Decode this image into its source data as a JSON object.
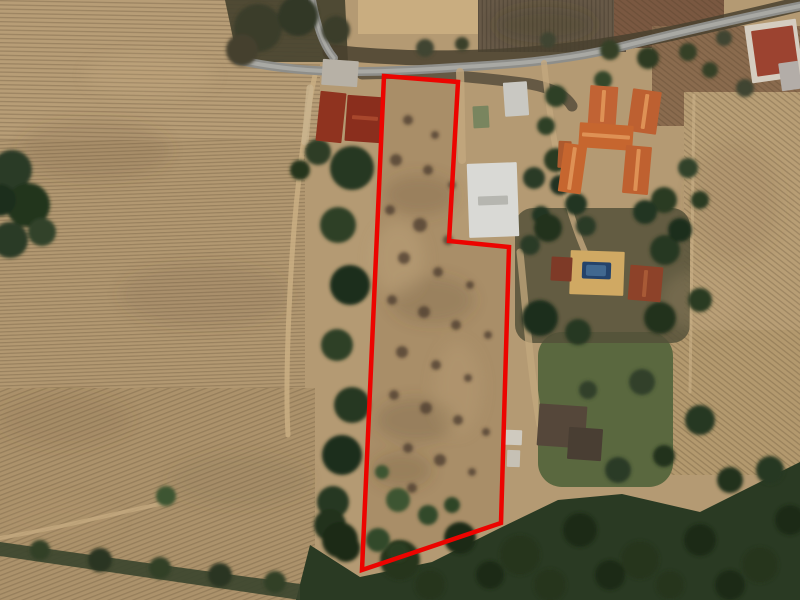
{
  "view": {
    "type": "satellite-aerial-imagery",
    "overlay": "land-parcel-boundary",
    "boundary_color": "#ec0400"
  },
  "scene": {
    "canvas": {
      "width": 800,
      "height": 600
    },
    "base_color": "#b49a73",
    "parcel": {
      "points": "384,76 458,82 449,241 509,247 501,523 362,570",
      "fill": "#a98e68",
      "stroke": "#ec0400",
      "stroke_width": 4.5
    },
    "parcel_tree_color": "#4a3b2c",
    "fields": [
      {
        "name": "field-west-top",
        "x": 0,
        "y": 0,
        "w": 320,
        "h": 150,
        "fill": "#b79d76",
        "pattern": "pat-rows-h"
      },
      {
        "name": "field-west-mid",
        "x": 0,
        "y": 140,
        "w": 305,
        "h": 255,
        "fill": "#b29871",
        "pattern": "pat-rows-h2"
      },
      {
        "name": "field-west-bottom",
        "x": 0,
        "y": 388,
        "w": 315,
        "h": 217,
        "fill": "#ac926b",
        "pattern": "pat-rows-d1"
      },
      {
        "name": "field-north-bare",
        "x": 358,
        "y": 0,
        "w": 125,
        "h": 34,
        "fill": "#c9ad80"
      },
      {
        "name": "field-north-dark",
        "x": 478,
        "y": 0,
        "w": 148,
        "h": 52,
        "fill": "#675947",
        "pattern": "pat-rows-v"
      },
      {
        "name": "field-north-red",
        "x": 614,
        "y": 0,
        "w": 110,
        "h": 48,
        "fill": "#7a5841",
        "pattern": "pat-rows-d2"
      },
      {
        "name": "field-ne-brown",
        "x": 652,
        "y": 26,
        "w": 148,
        "h": 100,
        "fill": "#8a6b4e",
        "pattern": "pat-rows-d2"
      },
      {
        "name": "field-east",
        "x": 684,
        "y": 92,
        "w": 116,
        "h": 305,
        "fill": "#b89e75",
        "pattern": "pat-rows-d2"
      },
      {
        "name": "field-se",
        "x": 655,
        "y": 330,
        "w": 145,
        "h": 145,
        "fill": "#b3996e",
        "pattern": "pat-rows-d2"
      },
      {
        "name": "lawn-se",
        "x": 538,
        "y": 332,
        "w": 135,
        "h": 155,
        "fill": "#5a683f",
        "rx": 24
      },
      {
        "name": "compound-ground",
        "x": 515,
        "y": 208,
        "w": 175,
        "h": 135,
        "fill": "#55513a",
        "rx": 18,
        "opacity": 0.85
      }
    ],
    "polys": [
      {
        "name": "treeband-northwest",
        "points": "225,0 345,0 348,62 238,62",
        "fill": "#46432f",
        "opacity": 0.92
      },
      {
        "name": "vegetation-south-band",
        "points": "296,600 310,545 360,577 432,562 500,528 558,500 622,494 700,512 800,462 800,600",
        "fill": "#2a3a23",
        "opacity": 1
      },
      {
        "name": "hedge-southwest",
        "points": "0,542 140,562 300,584 300,600 0,556",
        "fill": "#3a452e",
        "opacity": 0.9
      }
    ],
    "mottles": [
      [
        420,
        195,
        36,
        20,
        "#6b5740",
        0.25
      ],
      [
        432,
        300,
        42,
        24,
        "#66523c",
        0.2
      ],
      [
        416,
        420,
        40,
        22,
        "#5f4c38",
        0.22
      ],
      [
        398,
        258,
        26,
        36,
        "#c9b086",
        0.28
      ],
      [
        458,
        388,
        24,
        46,
        "#c4aa80",
        0.22
      ],
      [
        402,
        470,
        30,
        18,
        "#57452f",
        0.2
      ],
      [
        95,
        150,
        75,
        30,
        "#6f583e",
        0.16
      ],
      [
        205,
        295,
        85,
        32,
        "#6f583e",
        0.13
      ],
      [
        65,
        420,
        65,
        26,
        "#7a6247",
        0.13
      ],
      [
        150,
        75,
        65,
        22,
        "#cdb387",
        0.18
      ],
      [
        240,
        480,
        70,
        26,
        "#77604a",
        0.12
      ],
      [
        60,
        520,
        60,
        22,
        "#b79c72",
        0.15
      ],
      [
        735,
        200,
        45,
        60,
        "#8a6f4e",
        0.15
      ],
      [
        700,
        300,
        40,
        30,
        "#c4a97d",
        0.18
      ],
      [
        545,
        25,
        50,
        18,
        "#3f3626",
        0.25
      ]
    ],
    "roads": [
      {
        "name": "scrub-north-band",
        "d": "M 330,52 C 420,62 500,58 570,50 C 640,42 700,28 800,4",
        "stroke": "#49412f",
        "width": 15,
        "opacity": 0.85
      },
      {
        "name": "scrub-south-band",
        "d": "M 362,74 C 420,72 470,76 530,84 C 552,88 566,96 572,106",
        "stroke": "#4b4334",
        "width": 11,
        "opacity": 0.75
      },
      {
        "name": "dirt-track-west",
        "d": "M 316,70 C 303,130 294,210 290,290 C 287,350 286,400 288,435",
        "stroke": "#c9ae83",
        "width": 5,
        "opacity": 0.85
      },
      {
        "name": "main-road",
        "d": "M 238,60 C 300,74 360,73 430,69 C 500,65 560,62 620,47 C 680,32 740,18 800,6",
        "stroke": "#8e8e8a",
        "width": 9,
        "opacity": 1
      },
      {
        "name": "main-road-center",
        "d": "M 238,60 C 300,74 360,73 430,69 C 500,65 560,62 620,47 C 680,32 740,18 800,6",
        "stroke": "#a9a9a4",
        "width": 4,
        "opacity": 1
      },
      {
        "name": "north-road",
        "d": "M 312,0 C 316,22 322,44 334,58",
        "stroke": "#8e8e8a",
        "width": 8,
        "opacity": 1
      },
      {
        "name": "north-road-center",
        "d": "M 312,0 C 316,22 322,44 334,58",
        "stroke": "#a9a9a4",
        "width": 3,
        "opacity": 1
      },
      {
        "name": "driveway-warehouse",
        "d": "M 460,72 C 461,100 461,130 462,160",
        "stroke": "#c3a87e",
        "width": 8,
        "opacity": 0.8
      },
      {
        "name": "driveway-east",
        "d": "M 520,252 C 526,310 530,370 540,425",
        "stroke": "#c3a87e",
        "width": 7,
        "opacity": 0.75
      },
      {
        "name": "compound-drive",
        "d": "M 544,63 C 550,120 560,195 585,252",
        "stroke": "#c3a87e",
        "width": 6,
        "opacity": 0.8
      },
      {
        "name": "house-driveway-west",
        "d": "M 310,88 L 305,142",
        "stroke": "#c9b48e",
        "width": 7,
        "opacity": 0.8
      },
      {
        "name": "field-divider-east",
        "d": "M 694,95 L 690,392",
        "stroke": "#c9b187",
        "width": 3,
        "opacity": 0.6
      },
      {
        "name": "path-southwest",
        "d": "M 0,538 C 60,528 120,512 165,503",
        "stroke": "#c9ae83",
        "width": 4,
        "opacity": 0.7
      }
    ],
    "trees": [
      [
        12,
        170,
        20,
        "#2c3b26"
      ],
      [
        28,
        205,
        22,
        "#24341f"
      ],
      [
        10,
        240,
        18,
        "#2c3b26"
      ],
      [
        42,
        232,
        14,
        "#33422a"
      ],
      [
        0,
        200,
        16,
        "#1f2d1a"
      ],
      [
        166,
        496,
        10,
        "#3c5531"
      ],
      [
        352,
        168,
        22,
        "#263722"
      ],
      [
        338,
        225,
        18,
        "#2e4026"
      ],
      [
        350,
        285,
        20,
        "#1f2f1c"
      ],
      [
        337,
        345,
        16,
        "#2e4026"
      ],
      [
        352,
        405,
        18,
        "#263722"
      ],
      [
        342,
        455,
        20,
        "#1f2f1c"
      ],
      [
        333,
        502,
        16,
        "#263722"
      ],
      [
        330,
        525,
        16,
        "#22311d"
      ],
      [
        346,
        548,
        14,
        "#1d2a17"
      ],
      [
        318,
        152,
        13,
        "#2e3d25"
      ],
      [
        300,
        170,
        10,
        "#26351e"
      ],
      [
        258,
        28,
        24,
        "#3b3c2b"
      ],
      [
        298,
        16,
        20,
        "#323826"
      ],
      [
        242,
        50,
        16,
        "#443f2e"
      ],
      [
        336,
        30,
        14,
        "#3b3c2b"
      ],
      [
        425,
        48,
        9,
        "#3f4430"
      ],
      [
        462,
        44,
        7,
        "#3a3f2c"
      ],
      [
        548,
        40,
        8,
        "#3f4430"
      ],
      [
        610,
        50,
        10,
        "#364028"
      ],
      [
        648,
        58,
        11,
        "#2f3a24"
      ],
      [
        688,
        52,
        9,
        "#364028"
      ],
      [
        724,
        38,
        8,
        "#3f4430"
      ],
      [
        758,
        52,
        7,
        "#364028"
      ],
      [
        534,
        178,
        11,
        "#2c3b26"
      ],
      [
        541,
        215,
        9,
        "#243420"
      ],
      [
        530,
        245,
        10,
        "#2c3b26"
      ],
      [
        556,
        96,
        11,
        "#2e4026"
      ],
      [
        603,
        80,
        9,
        "#36462b"
      ],
      [
        664,
        200,
        13,
        "#2a3a24"
      ],
      [
        576,
        204,
        11,
        "#243420"
      ],
      [
        546,
        126,
        9,
        "#2e4026"
      ],
      [
        688,
        168,
        10,
        "#33432a"
      ],
      [
        700,
        200,
        9,
        "#2a3a24"
      ],
      [
        645,
        212,
        12,
        "#243420"
      ],
      [
        586,
        226,
        10,
        "#2c3b26"
      ],
      [
        556,
        160,
        12,
        "#2a3a24"
      ],
      [
        560,
        185,
        10,
        "#223320"
      ],
      [
        548,
        228,
        14,
        "#22311d"
      ],
      [
        665,
        250,
        15,
        "#283823"
      ],
      [
        540,
        318,
        18,
        "#1f2e1b"
      ],
      [
        578,
        332,
        13,
        "#283823"
      ],
      [
        660,
        318,
        16,
        "#22311d"
      ],
      [
        700,
        300,
        12,
        "#2a3a24"
      ],
      [
        680,
        230,
        12,
        "#1f2e1b"
      ],
      [
        642,
        382,
        13,
        "#31412a"
      ],
      [
        700,
        420,
        15,
        "#283823"
      ],
      [
        664,
        456,
        11,
        "#22311d"
      ],
      [
        618,
        470,
        13,
        "#2c3b26"
      ],
      [
        588,
        390,
        9,
        "#31412a"
      ],
      [
        745,
        88,
        9,
        "#3f4430"
      ],
      [
        710,
        70,
        8,
        "#364028"
      ],
      [
        770,
        470,
        14,
        "#283823"
      ],
      [
        730,
        480,
        13,
        "#22311d"
      ],
      [
        340,
        540,
        18,
        "#1d2a17"
      ],
      [
        400,
        560,
        20,
        "#26351f"
      ],
      [
        460,
        538,
        16,
        "#1d2a17"
      ],
      [
        520,
        555,
        20,
        "#26351f"
      ],
      [
        580,
        530,
        17,
        "#1d2a17"
      ],
      [
        640,
        560,
        19,
        "#26351f"
      ],
      [
        700,
        540,
        16,
        "#1d2a17"
      ],
      [
        760,
        565,
        18,
        "#26351f"
      ],
      [
        790,
        520,
        15,
        "#1d2a17"
      ],
      [
        430,
        585,
        15,
        "#26351f"
      ],
      [
        490,
        575,
        14,
        "#1d2a17"
      ],
      [
        550,
        585,
        16,
        "#26351f"
      ],
      [
        610,
        575,
        15,
        "#1d2a17"
      ],
      [
        670,
        585,
        14,
        "#26351f"
      ],
      [
        730,
        585,
        15,
        "#1d2a17"
      ],
      [
        40,
        550,
        10,
        "#323f28"
      ],
      [
        100,
        560,
        12,
        "#2a3622"
      ],
      [
        160,
        568,
        11,
        "#323f28"
      ],
      [
        220,
        575,
        12,
        "#2a3622"
      ],
      [
        275,
        582,
        11,
        "#323f28"
      ]
    ],
    "buildings": [
      {
        "name": "house-garage-white",
        "x": 322,
        "y": 60,
        "w": 36,
        "h": 26,
        "fill": "#b7b1a6",
        "rot": 4
      },
      {
        "name": "house-red-west",
        "x": 318,
        "y": 92,
        "w": 26,
        "h": 50,
        "fill": "#8f331f",
        "rot": 6
      },
      {
        "name": "house-red-main",
        "x": 346,
        "y": 96,
        "w": 36,
        "h": 46,
        "fill": "#8a2e1d",
        "rot": 4
      },
      {
        "name": "house-red-main-ridge",
        "x": 352,
        "y": 116,
        "w": 26,
        "h": 4,
        "fill": "#a8472c",
        "rot": 4
      },
      {
        "name": "outbuilding-gray",
        "x": 504,
        "y": 82,
        "w": 24,
        "h": 34,
        "fill": "#c9c8c2",
        "rot": -4
      },
      {
        "name": "shed-green-roof",
        "x": 473,
        "y": 106,
        "w": 16,
        "h": 22,
        "fill": "#79855f",
        "rot": -3
      },
      {
        "name": "warehouse",
        "x": 468,
        "y": 163,
        "w": 50,
        "h": 74,
        "fill": "#d9d9d5",
        "rot": -2
      },
      {
        "name": "warehouse-roof-marks",
        "x": 478,
        "y": 196,
        "w": 30,
        "h": 9,
        "fill": "#b6b6b0",
        "rot": -2
      },
      {
        "name": "annex-orange",
        "x": 558,
        "y": 141,
        "w": 13,
        "h": 27,
        "fill": "#ad5a2e",
        "rot": 3
      },
      {
        "name": "temple-hall-north-west",
        "x": 589,
        "y": 86,
        "w": 28,
        "h": 40,
        "fill": "#c16334",
        "rot": 4
      },
      {
        "name": "temple-hall-north-west-ridge",
        "x": 601,
        "y": 90,
        "w": 4,
        "h": 32,
        "fill": "#de9155",
        "rot": 4
      },
      {
        "name": "temple-hall-north-east",
        "x": 630,
        "y": 90,
        "w": 29,
        "h": 43,
        "fill": "#bd6031",
        "rot": 8
      },
      {
        "name": "temple-hall-north-east-ridge",
        "x": 643,
        "y": 94,
        "w": 4,
        "h": 35,
        "fill": "#de9155",
        "rot": 8
      },
      {
        "name": "temple-wing-top",
        "x": 579,
        "y": 124,
        "w": 54,
        "h": 25,
        "fill": "#c6662f",
        "rot": 4
      },
      {
        "name": "temple-wing-top-ridge",
        "x": 582,
        "y": 134,
        "w": 48,
        "h": 4,
        "fill": "#de9155",
        "rot": 4
      },
      {
        "name": "temple-wing-west",
        "x": 561,
        "y": 144,
        "w": 23,
        "h": 49,
        "fill": "#c6662f",
        "rot": 8
      },
      {
        "name": "temple-wing-west-ridge",
        "x": 570,
        "y": 147,
        "w": 4,
        "h": 43,
        "fill": "#de9155",
        "rot": 8
      },
      {
        "name": "temple-wing-east",
        "x": 624,
        "y": 146,
        "w": 26,
        "h": 48,
        "fill": "#bf6130",
        "rot": 5
      },
      {
        "name": "temple-wing-east-ridge",
        "x": 635,
        "y": 149,
        "w": 4,
        "h": 42,
        "fill": "#de9155",
        "rot": 5
      },
      {
        "name": "pool-terrace",
        "x": 570,
        "y": 251,
        "w": 54,
        "h": 44,
        "fill": "#d0a963",
        "rot": 2
      },
      {
        "name": "swimming-pool",
        "x": 582,
        "y": 262,
        "w": 29,
        "h": 17,
        "fill": "#24436b",
        "rot": 2,
        "rx": 2
      },
      {
        "name": "pool-water-light",
        "x": 586,
        "y": 265,
        "w": 20,
        "h": 11,
        "fill": "#41688f",
        "rot": 2,
        "rx": 2
      },
      {
        "name": "pool-house-west",
        "x": 551,
        "y": 257,
        "w": 21,
        "h": 24,
        "fill": "#7e3a27",
        "rot": 3
      },
      {
        "name": "pool-house-east",
        "x": 629,
        "y": 266,
        "w": 33,
        "h": 35,
        "fill": "#8d4229",
        "rot": 5
      },
      {
        "name": "pool-house-east-ridge",
        "x": 643,
        "y": 270,
        "w": 4,
        "h": 27,
        "fill": "#a85a36",
        "rot": 5
      },
      {
        "name": "house-se-main",
        "x": 538,
        "y": 405,
        "w": 48,
        "h": 42,
        "fill": "#55473a",
        "rot": 4
      },
      {
        "name": "house-se-wing",
        "x": 568,
        "y": 428,
        "w": 34,
        "h": 32,
        "fill": "#493e33",
        "rot": 4
      },
      {
        "name": "shed-white-a",
        "x": 505,
        "y": 430,
        "w": 17,
        "h": 15,
        "fill": "#cfcabf",
        "rot": 2
      },
      {
        "name": "shed-white-b",
        "x": 507,
        "y": 450,
        "w": 13,
        "h": 17,
        "fill": "#c6c1b5",
        "rot": 2
      },
      {
        "name": "ne-concrete-pad",
        "x": 748,
        "y": 22,
        "w": 52,
        "h": 58,
        "fill": "#d5cdc0",
        "rot": -8
      },
      {
        "name": "ne-house-red",
        "x": 754,
        "y": 28,
        "w": 42,
        "h": 46,
        "fill": "#9c4330",
        "rot": -8
      },
      {
        "name": "ne-roof-gray",
        "x": 780,
        "y": 62,
        "w": 20,
        "h": 28,
        "fill": "#b3ada8",
        "rot": -8
      }
    ],
    "parcel_trees": [
      [
        408,
        120,
        5
      ],
      [
        435,
        135,
        4
      ],
      [
        396,
        160,
        6
      ],
      [
        428,
        170,
        5
      ],
      [
        452,
        185,
        4
      ],
      [
        390,
        210,
        5
      ],
      [
        420,
        225,
        7
      ],
      [
        448,
        240,
        5
      ],
      [
        404,
        258,
        6
      ],
      [
        438,
        272,
        5
      ],
      [
        470,
        285,
        4
      ],
      [
        392,
        300,
        5
      ],
      [
        424,
        312,
        6
      ],
      [
        456,
        325,
        5
      ],
      [
        488,
        335,
        4
      ],
      [
        402,
        352,
        6
      ],
      [
        436,
        365,
        5
      ],
      [
        468,
        378,
        4
      ],
      [
        394,
        395,
        5
      ],
      [
        426,
        408,
        6
      ],
      [
        458,
        420,
        5
      ],
      [
        486,
        432,
        4
      ],
      [
        408,
        448,
        5
      ],
      [
        440,
        460,
        6
      ],
      [
        472,
        472,
        4
      ],
      [
        412,
        488,
        5
      ]
    ],
    "parcel_bushes": [
      [
        398,
        500,
        12,
        "#3e5430"
      ],
      [
        428,
        515,
        10,
        "#33482a"
      ],
      [
        382,
        472,
        7,
        "#3e5430"
      ],
      [
        452,
        505,
        8,
        "#2f4426"
      ],
      [
        378,
        540,
        12,
        "#33482a"
      ],
      [
        398,
        552,
        10,
        "#2a3d22"
      ]
    ]
  }
}
